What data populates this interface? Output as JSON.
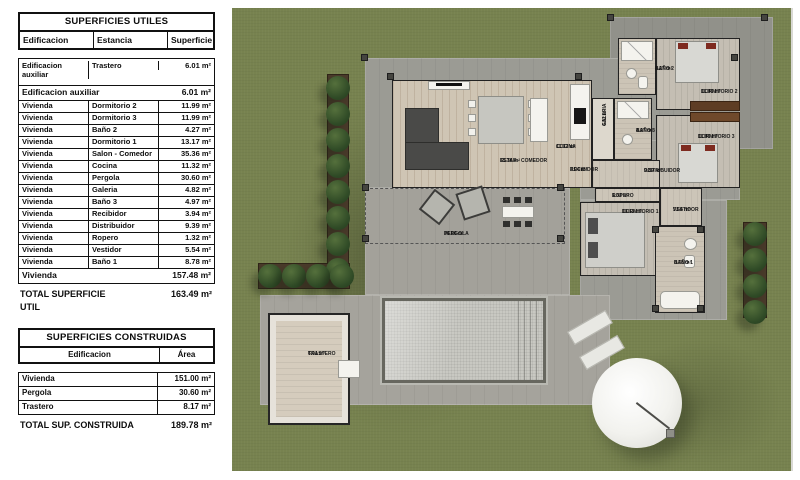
{
  "tables": {
    "utiles": {
      "title": "SUPERFICIES UTILES",
      "columns": [
        "Edificacion",
        "Estancia",
        "Superficie"
      ],
      "aux_row": {
        "edificacion": "Edificacion auxiliar",
        "estancia": "Trastero",
        "superficie": "6.01 m²"
      },
      "aux_subtotal": {
        "label": "Edificacion auxiliar",
        "value": "6.01 m²"
      },
      "rows": [
        {
          "edificacion": "Vivienda",
          "estancia": "Dormitorio 2",
          "superficie": "11.99 m²"
        },
        {
          "edificacion": "Vivienda",
          "estancia": "Dormitorio 3",
          "superficie": "11.99 m²"
        },
        {
          "edificacion": "Vivienda",
          "estancia": "Baño 2",
          "superficie": "4.27 m²"
        },
        {
          "edificacion": "Vivienda",
          "estancia": "Dormitorio 1",
          "superficie": "13.17 m²"
        },
        {
          "edificacion": "Vivienda",
          "estancia": "Salon - Comedor",
          "superficie": "35.36 m²"
        },
        {
          "edificacion": "Vivienda",
          "estancia": "Cocina",
          "superficie": "11.32 m²"
        },
        {
          "edificacion": "Vivienda",
          "estancia": "Pergola",
          "superficie": "30.60 m²"
        },
        {
          "edificacion": "Vivienda",
          "estancia": "Galeria",
          "superficie": "4.82 m²"
        },
        {
          "edificacion": "Vivienda",
          "estancia": "Baño 3",
          "superficie": "4.97 m²"
        },
        {
          "edificacion": "Vivienda",
          "estancia": "Recibidor",
          "superficie": "3.94 m²"
        },
        {
          "edificacion": "Vivienda",
          "estancia": "Distribuidor",
          "superficie": "9.39 m²"
        },
        {
          "edificacion": "Vivienda",
          "estancia": "Ropero",
          "superficie": "1.32 m²"
        },
        {
          "edificacion": "Vivienda",
          "estancia": "Vestidor",
          "superficie": "5.54 m²"
        },
        {
          "edificacion": "Vivienda",
          "estancia": "Baño 1",
          "superficie": "8.78 m²"
        }
      ],
      "vivienda_subtotal": {
        "label": "Vivienda",
        "value": "157.48 m²"
      },
      "total": {
        "label": "TOTAL SUPERFICIE UTIL",
        "value": "163.49 m²"
      }
    },
    "construidas": {
      "title": "SUPERFICIES CONSTRUIDAS",
      "columns": [
        "Edificacion",
        "Área"
      ],
      "rows": [
        {
          "edificacion": "Vivienda",
          "area": "151.00 m²"
        },
        {
          "edificacion": "Pergola",
          "area": "30.60 m²"
        },
        {
          "edificacion": "Trastero",
          "area": "8.17 m²"
        }
      ],
      "total": {
        "label": "TOTAL SUP. CONSTRUIDA",
        "value": "189.78 m²"
      }
    }
  },
  "plan": {
    "labels": [
      {
        "name": "ESTAR - COMEDOR",
        "area": "35.36 m²"
      },
      {
        "name": "COCINA",
        "area": "11.32 m²"
      },
      {
        "name": "RECIBIDOR",
        "area": "3.94 m²"
      },
      {
        "name": "GALERIA",
        "area": "4.82 m²"
      },
      {
        "name": "BAÑO 3",
        "area": "4.97 m²"
      },
      {
        "name": "BAÑO 2",
        "area": "4.27 m²"
      },
      {
        "name": "DORMITORIO 2",
        "area": "11.99 m²"
      },
      {
        "name": "DORMITORIO 3",
        "area": "11.99 m²"
      },
      {
        "name": "DISTRIBUIDOR",
        "area": "9.39 m²"
      },
      {
        "name": "ROPERO",
        "area": "1.32 m²"
      },
      {
        "name": "DORMITORIO 1",
        "area": "13.17 m²"
      },
      {
        "name": "VESTIDOR",
        "area": "5.54 m²"
      },
      {
        "name": "BAÑO 1",
        "area": "8.78 m²"
      },
      {
        "name": "PERGOLA",
        "area": "30.60 m²"
      },
      {
        "name": "TRASTERO",
        "area": "6.01 m²"
      }
    ]
  }
}
